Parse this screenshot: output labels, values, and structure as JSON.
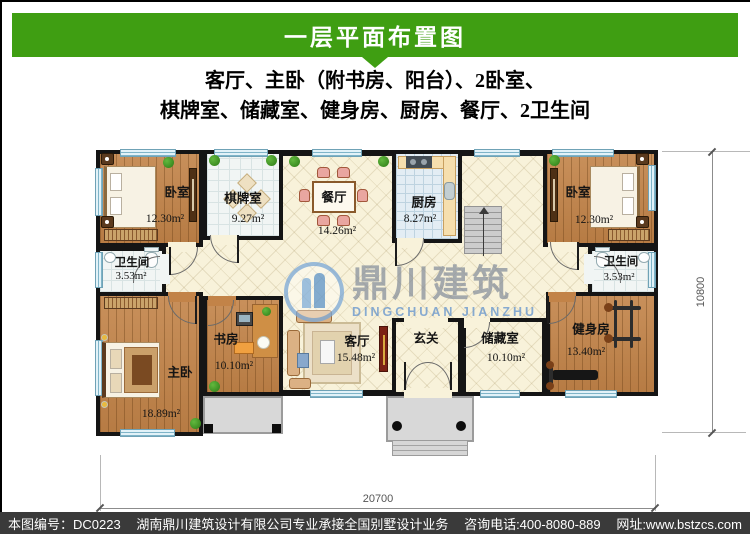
{
  "header": {
    "title": "一层平面布置图"
  },
  "subtitle": {
    "line1": "客厅、主卧（附书房、阳台）、2卧室、",
    "line2": "棋牌室、储藏室、健身房、厨房、餐厅、2卫生间"
  },
  "watermark": {
    "name": "鼎川建筑",
    "latin": "DINGCHUAN JIANZHU"
  },
  "dimensions": {
    "width": "20700",
    "height": "10800"
  },
  "rooms": [
    {
      "id": "bedroom-top-left",
      "name": "卧室",
      "area": "12.30m²"
    },
    {
      "id": "game-room",
      "name": "棋牌室",
      "area": "9.27m²"
    },
    {
      "id": "dining-room",
      "name": "餐厅",
      "area": "14.26m²"
    },
    {
      "id": "kitchen",
      "name": "厨房",
      "area": "8.27m²"
    },
    {
      "id": "bedroom-top-right",
      "name": "卧室",
      "area": "12.30m²"
    },
    {
      "id": "bathroom-left",
      "name": "卫生间",
      "area": "3.53m²"
    },
    {
      "id": "bathroom-right",
      "name": "卫生间",
      "area": "3.53m²"
    },
    {
      "id": "master-bedroom",
      "name": "主卧",
      "area": "18.89m²"
    },
    {
      "id": "study",
      "name": "书房",
      "area": "10.10m²"
    },
    {
      "id": "living-room",
      "name": "客厅",
      "area": "15.48m²"
    },
    {
      "id": "foyer",
      "name": "玄关",
      "area": ""
    },
    {
      "id": "storage",
      "name": "储藏室",
      "area": "10.10m²"
    },
    {
      "id": "gym",
      "name": "健身房",
      "area": "13.40m²"
    }
  ],
  "footer": {
    "plan_no": "本图编号：DC0223",
    "company": "湖南鼎川建筑设计有限公司专业承接全国别墅设计业务",
    "phone": "咨询电话:400-8080-889",
    "website": "网址:www.bstzcs.com"
  },
  "colors": {
    "banner_green": "#3f9e12",
    "footer_bg": "#3a3a3a",
    "wall": "#151515"
  }
}
